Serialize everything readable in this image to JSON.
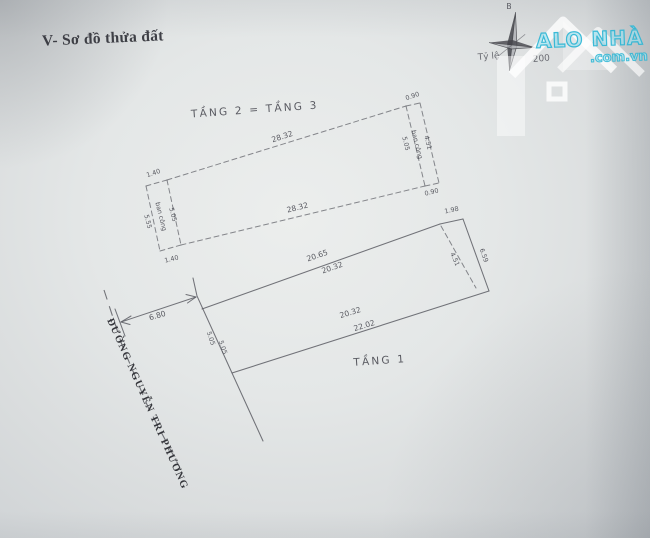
{
  "header": {
    "title": "V- Sơ đồ thửa đất"
  },
  "compass": {
    "north_label": "B"
  },
  "scale": {
    "label": "Tỷ lệ",
    "value": "200"
  },
  "watermark": {
    "brand": "ALO NHÀ ĐẤT",
    "domain": ".com.vn",
    "accent_color": "#2ab5d4"
  },
  "floors": {
    "upper": "TẦNG 2 = TẦNG 3",
    "ground": "TẦNG 1"
  },
  "street": {
    "name": "ĐƯỜNG NGUYỄN TRI PHƯƠNG"
  },
  "dims": {
    "upper_top": "28.32",
    "upper_bottom": "28.32",
    "lb_top": "1.40",
    "lb_bottom": "1.40",
    "lb_outer": "5.55",
    "lb_inner": "5.05",
    "lb_label": "ban công",
    "rb_top": "0.90",
    "rb_bottom": "0.90",
    "rb_inner": "5.05",
    "rb_label": "ban công",
    "rb_outer": "4.51",
    "plot_top_a": "20.65",
    "plot_top_b": "20.32",
    "plot_right_offset": "1.98",
    "plot_right_inner": "4.51",
    "plot_right_outer": "6.59",
    "ground_top_a": "20.32",
    "ground_top_b": "22.02",
    "street_w_a": "5.05",
    "street_w_b": "5.05",
    "setback": "6.80"
  }
}
